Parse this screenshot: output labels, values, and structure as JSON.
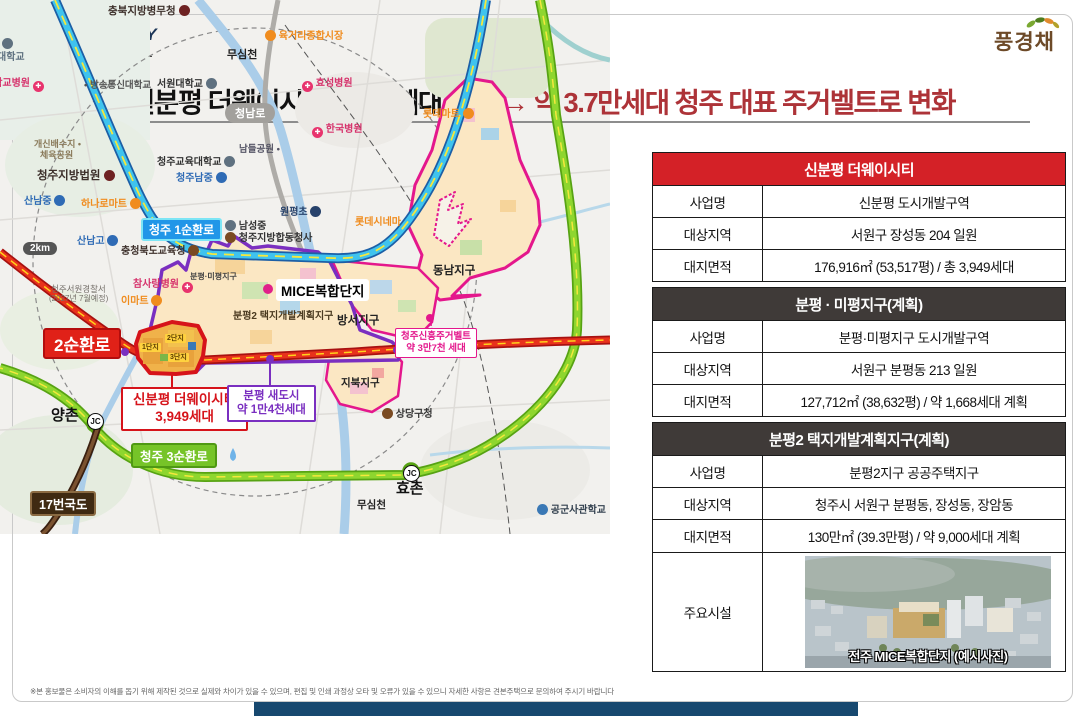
{
  "brand": {
    "badge": "신분평",
    "the": "THE",
    "waycity": "WAY CITY",
    "sub": "제일풍경채",
    "divider": "|",
    "block": "1BL",
    "right_logo": "풍경채"
  },
  "headline": {
    "black": "신분평 더웨이시티 3,949세대 포함",
    "arrow": "→",
    "red": "약 3.7만세대 청주 대표 주거벨트로 변화"
  },
  "colors": {
    "accent_red": "#d42127",
    "dark_header": "#3f3a38",
    "headline_red": "#ad3338",
    "magenta": "#e4178c",
    "purple": "#7a2fc0",
    "site_red": "#d6131a"
  },
  "icons": {
    "cross": "✚",
    "dot": "•"
  },
  "tables": [
    {
      "title": "신분평 더웨이시티",
      "rows": [
        {
          "label": "사업명",
          "value": "신분평 도시개발구역"
        },
        {
          "label": "대상지역",
          "value": "서원구 장성동 204 일원"
        },
        {
          "label": "대지면적",
          "value": "176,916㎡ (53,517평) / 총 3,949세대"
        }
      ]
    },
    {
      "title": "분평 · 미평지구(계획)",
      "rows": [
        {
          "label": "사업명",
          "value": "분평·미평지구 도시개발구역"
        },
        {
          "label": "대상지역",
          "value": "서원구 분평동 213 일원"
        },
        {
          "label": "대지면적",
          "value": "127,712㎡ (38,632평) / 약 1,668세대 계획"
        }
      ]
    },
    {
      "title": "분평2 택지개발계획지구(계획)",
      "rows": [
        {
          "label": "사업명",
          "value": "분평2지구 공공주택지구"
        },
        {
          "label": "대상지역",
          "value": "청주시 서원구 분평동, 장성동, 장암동"
        },
        {
          "label": "대지면적",
          "value": "130만㎡ (39.3만평) / 약 9,000세대 계획"
        },
        {
          "label": "주요시설",
          "value": ""
        }
      ]
    }
  ],
  "facility_caption": "전주 MICE복합단지 (예시사진)",
  "map": {
    "road_labels": [
      "청주 1순환로",
      "2순환로",
      "청주 3순환로",
      "17번국도",
      "청남로",
      "2km",
      "JC"
    ],
    "districts": [
      "분평·미평지구",
      "분평2 택지개발계획지구",
      "방서지구",
      "동남지구",
      "지북지구",
      "MICE복합단지"
    ],
    "callouts": [
      {
        "l1": "신분평 더웨이시티",
        "l2": "3,949세대"
      },
      {
        "l1": "분평 새도시",
        "l2": "약 1만4천세대"
      },
      {
        "l1": "청주신흥주거벨트",
        "l2": "약 3만7천 세대"
      }
    ],
    "site_units": [
      "1단지",
      "2단지",
      "3단지"
    ],
    "pois": [
      "충북지방병무청",
      "육거리종합시장",
      "무심천",
      "대학교",
      "대학교병원",
      "방송통신대학교",
      "서원대학교",
      "효성병원",
      "한국병원",
      "개신배수지 •",
      "체육공원",
      "청주교육대학교",
      "남들공원 •",
      "청주남중",
      "청주지방법원",
      "하나로마트",
      "산남중",
      "산남고",
      "충청북도교육청",
      "원평초",
      "남성중",
      "청주지방합동청사",
      "롯데시네마",
      "롯데마트",
      "참사랑병원",
      "이마트",
      "청주서원경찰서",
      "(2027년 7월예정)",
      "상당구청",
      "양촌",
      "효촌",
      "무심천",
      "공군사관학교"
    ]
  },
  "footer": "※본 홍보물은 소비자의 이해를 돕기 위해 제작된 것으로 실제와 차이가 있을 수 있으며, 편집 및 인쇄 과정상 오타 및 오류가 있을 수 있으니 자세한 사항은 견본주택으로 문의하여 주시기 바랍니다"
}
